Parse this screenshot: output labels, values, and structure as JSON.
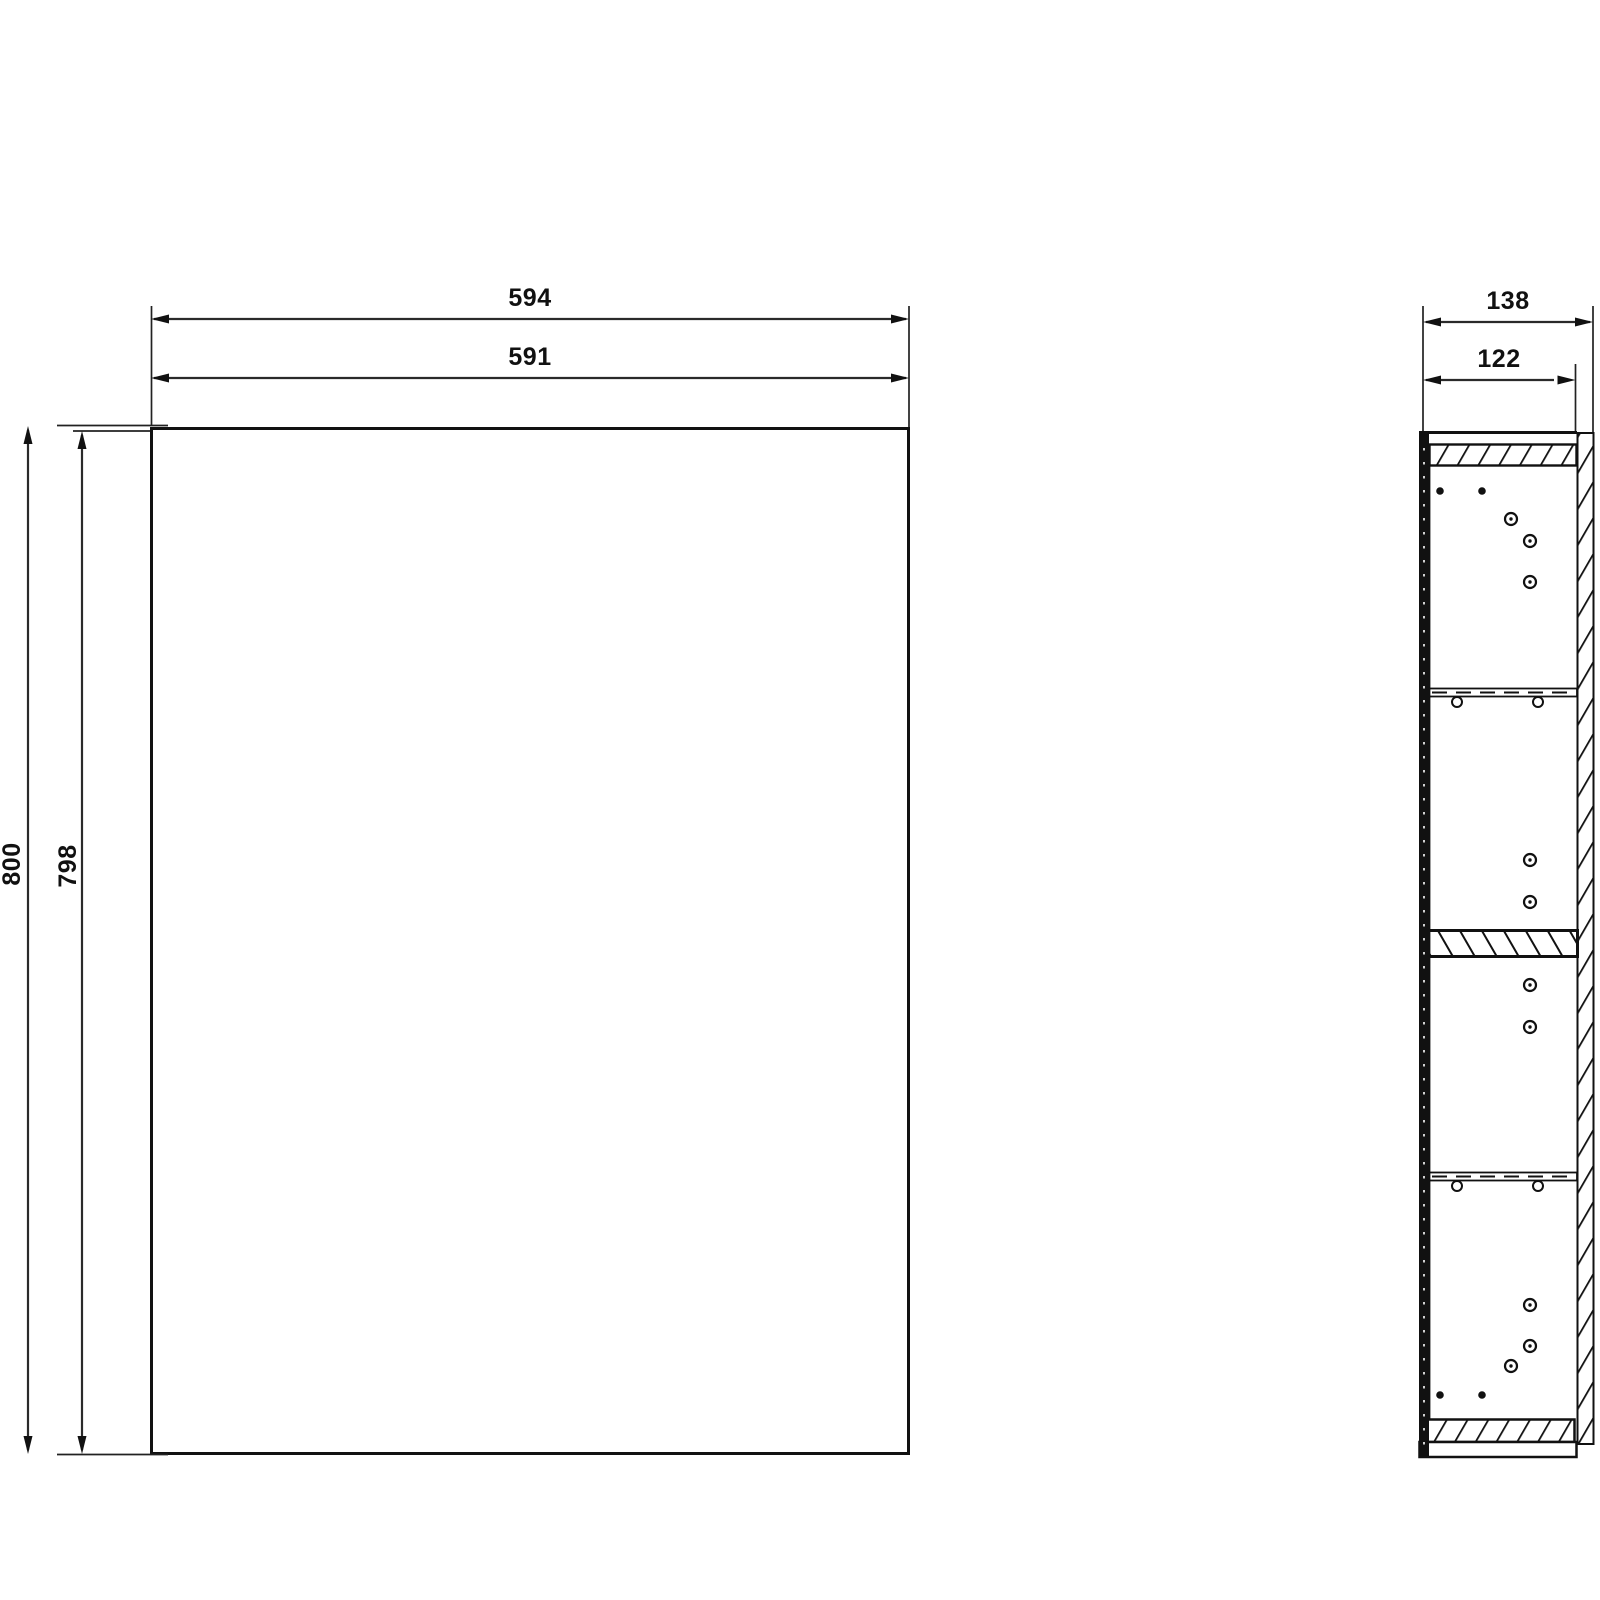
{
  "dimensions": {
    "front": {
      "width_outer": "594",
      "width_inner": "591",
      "height_outer": "800",
      "height_inner": "798"
    },
    "side": {
      "depth_outer": "138",
      "depth_inner": "122"
    }
  },
  "colors": {
    "line": "#111111",
    "dim_line": "#2a2a2a",
    "background": "#ffffff"
  }
}
